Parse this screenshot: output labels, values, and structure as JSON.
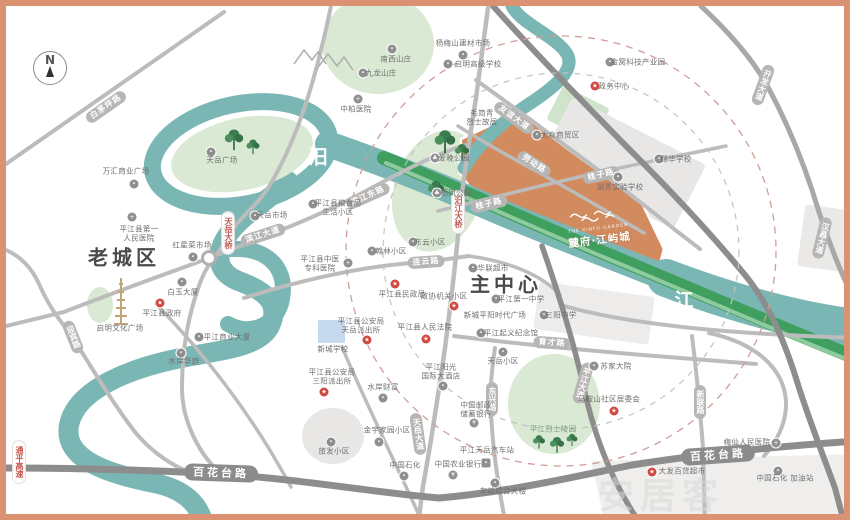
{
  "compass": {
    "letter": "N"
  },
  "project": {
    "name": "麓府·江屿城",
    "latin": "THE XINFU GARDEN"
  },
  "watermark": {
    "text": "安居客"
  },
  "districts": [
    {
      "t": "老城区",
      "x": 118,
      "y": 250
    },
    {
      "t": "主中心",
      "x": 500,
      "y": 277
    }
  ],
  "river_label": {
    "name": "汨罗江",
    "chars": [
      {
        "c": "汨",
        "x": 312,
        "y": 150
      },
      {
        "c": "罗",
        "x": 492,
        "y": 240
      },
      {
        "c": "江",
        "x": 678,
        "y": 293
      }
    ]
  },
  "band_label": {
    "name": "大众风光带",
    "chars": [
      {
        "c": "大",
        "x": 470,
        "y": 221
      },
      {
        "c": "众",
        "x": 498,
        "y": 231
      },
      {
        "c": "风",
        "x": 526,
        "y": 242
      },
      {
        "c": "光",
        "x": 554,
        "y": 252
      },
      {
        "c": "带",
        "x": 582,
        "y": 262
      }
    ]
  },
  "capsules": [
    {
      "t": "白茅坪路",
      "x": 100,
      "y": 101,
      "r": -35
    },
    {
      "t": "滨江大道",
      "x": 257,
      "y": 229,
      "r": -18
    },
    {
      "t": "滨江东路",
      "x": 362,
      "y": 190,
      "r": -24
    },
    {
      "t": "天岳大桥",
      "x": 222,
      "y": 227,
      "v": 1,
      "red": 1
    },
    {
      "t": "连云路",
      "x": 420,
      "y": 256,
      "r": -4
    },
    {
      "t": "汨江大桥",
      "x": 452,
      "y": 206,
      "v": 1,
      "red": 1
    },
    {
      "t": "友谊大道",
      "x": 508,
      "y": 112,
      "r": 36
    },
    {
      "t": "劳动路",
      "x": 528,
      "y": 158,
      "r": 33
    },
    {
      "t": "桂子路",
      "x": 483,
      "y": 198,
      "r": -13
    },
    {
      "t": "桂子路",
      "x": 595,
      "y": 169,
      "r": -13
    },
    {
      "t": "开发大道",
      "x": 757,
      "y": 79,
      "v": 1,
      "r": 20
    },
    {
      "t": "汉昌大道",
      "x": 816,
      "y": 232,
      "v": 1,
      "r": 14
    },
    {
      "t": "育才路",
      "x": 546,
      "y": 337,
      "r": 4
    },
    {
      "t": "东兴路",
      "x": 486,
      "y": 393,
      "v": 1
    },
    {
      "t": "天岳大道",
      "x": 412,
      "y": 428,
      "v": 1,
      "r": -8
    },
    {
      "t": "新联路",
      "x": 694,
      "y": 396,
      "v": 1
    },
    {
      "t": "平江大道",
      "x": 577,
      "y": 377,
      "v": 1,
      "r": 16
    },
    {
      "t": "百花台路",
      "x": 215,
      "y": 467,
      "r": 2,
      "big": 1
    },
    {
      "t": "百花台路",
      "x": 712,
      "y": 449,
      "r": -4,
      "big": 1
    },
    {
      "t": "通平高速",
      "x": 13,
      "y": 456,
      "v": 1,
      "red": 1
    },
    {
      "t": "迎宾路",
      "x": 67,
      "y": 331,
      "v": 1,
      "r": -22
    }
  ],
  "pois": [
    {
      "t": "中柏医院",
      "x": 350,
      "y": 104,
      "ic": "hospital",
      "ix": 352,
      "iy": 93
    },
    {
      "t": "杨梅山建材市场",
      "x": 457,
      "y": 38,
      "ic": "market",
      "ix": 457,
      "iy": 49
    },
    {
      "t": "启明高级学校",
      "x": 472,
      "y": 59,
      "ic": "school",
      "ix": 442,
      "iy": 58
    },
    {
      "t": "南西山庄",
      "x": 390,
      "y": 54,
      "ic": "place",
      "ix": 386,
      "iy": 43
    },
    {
      "t": "九龙山庄",
      "x": 375,
      "y": 68,
      "ic": "place",
      "ix": 357,
      "iy": 67
    },
    {
      "t": "金窝科技产业园",
      "x": 632,
      "y": 57,
      "ic": "place",
      "ix": 604,
      "iy": 56
    },
    {
      "t": "政务中心",
      "x": 608,
      "y": 81,
      "ic": "govt",
      "ix": 589,
      "iy": 80
    },
    {
      "t": "毛简青\n烈士故居",
      "x": 476,
      "y": 112
    },
    {
      "t": "大众商贸区",
      "x": 554,
      "y": 130,
      "ic": "place",
      "ix": 531,
      "iy": 129
    },
    {
      "t": "郧华学校",
      "x": 670,
      "y": 154,
      "ic": "school",
      "ix": 653,
      "iy": 153
    },
    {
      "t": "湖青实验学校",
      "x": 614,
      "y": 182,
      "ic": "school",
      "ix": 612,
      "iy": 171
    },
    {
      "t": "爱晚公园",
      "x": 448,
      "y": 153,
      "ic": "park",
      "ix": 429,
      "iy": 152
    },
    {
      "t": "栖凤公园",
      "x": 450,
      "y": 188,
      "ic": "park",
      "ix": 431,
      "iy": 187
    },
    {
      "t": "天岳广场",
      "x": 216,
      "y": 155,
      "ic": "place",
      "ix": 205,
      "iy": 146
    },
    {
      "t": "万汇商业广场",
      "x": 120,
      "y": 166,
      "ic": "place",
      "ix": 128,
      "iy": 178
    },
    {
      "t": "天岳市场",
      "x": 266,
      "y": 210,
      "ic": "market",
      "ix": 249,
      "iy": 210
    },
    {
      "t": "红星菜市场",
      "x": 186,
      "y": 240,
      "ic": "market",
      "ix": 187,
      "iy": 251
    },
    {
      "t": "平江县第一\n人民医院",
      "x": 133,
      "y": 228,
      "ic": "hospital",
      "ix": 126,
      "iy": 211
    },
    {
      "t": "平江县粮食局\n生活小区",
      "x": 332,
      "y": 202,
      "ic": "place",
      "ix": 307,
      "iy": 198
    },
    {
      "t": "翰林小区",
      "x": 385,
      "y": 246,
      "ic": "place",
      "ix": 366,
      "iy": 245
    },
    {
      "t": "东云小区",
      "x": 424,
      "y": 237,
      "ic": "place",
      "ix": 407,
      "iy": 236
    },
    {
      "t": "平江县中医\n专科医院",
      "x": 314,
      "y": 258,
      "ic": "hospital",
      "ix": 342,
      "iy": 257
    },
    {
      "t": "华联超市",
      "x": 487,
      "y": 263,
      "ic": "market",
      "ix": 467,
      "iy": 262
    },
    {
      "t": "平江第一中学",
      "x": 515,
      "y": 294,
      "ic": "school",
      "ix": 490,
      "iy": 293
    },
    {
      "t": "新城平阳时代广场",
      "x": 489,
      "y": 310
    },
    {
      "t": "三阳中学",
      "x": 555,
      "y": 310,
      "ic": "school",
      "ix": 538,
      "iy": 309
    },
    {
      "t": "平江起义纪念馆",
      "x": 505,
      "y": 328,
      "ic": "place",
      "ix": 475,
      "iy": 327
    },
    {
      "t": "政协机关小区",
      "x": 438,
      "y": 291,
      "ic": "govt",
      "ix": 448,
      "iy": 300
    },
    {
      "t": "平江县民政局",
      "x": 396,
      "y": 289,
      "ic": "govt",
      "ix": 389,
      "iy": 278
    },
    {
      "t": "平江县人民法院",
      "x": 419,
      "y": 322,
      "ic": "govt",
      "ix": 420,
      "iy": 333
    },
    {
      "t": "平江县公安局\n天岳派出所",
      "x": 355,
      "y": 320,
      "ic": "govt",
      "ix": 361,
      "iy": 334
    },
    {
      "t": "新城学校",
      "x": 327,
      "y": 344
    },
    {
      "t": "白玉大厦",
      "x": 177,
      "y": 287,
      "ic": "place",
      "ix": 176,
      "iy": 276
    },
    {
      "t": "平江县政府",
      "x": 156,
      "y": 308,
      "ic": "govt",
      "ix": 154,
      "iy": 297
    },
    {
      "t": "启明文化广场",
      "x": 114,
      "y": 323
    },
    {
      "t": "水岸华庭",
      "x": 178,
      "y": 356,
      "ic": "place",
      "ix": 175,
      "iy": 347
    },
    {
      "t": "平江商业大厦",
      "x": 221,
      "y": 332,
      "ic": "place",
      "ix": 193,
      "iy": 331
    },
    {
      "t": "水岸财富",
      "x": 377,
      "y": 382,
      "ic": "place",
      "ix": 377,
      "iy": 392
    },
    {
      "t": "平江县公安局\n三阳派出所",
      "x": 326,
      "y": 371,
      "ic": "govt",
      "ix": 318,
      "iy": 386
    },
    {
      "t": "旅发小区",
      "x": 328,
      "y": 446,
      "ic": "place",
      "ix": 325,
      "iy": 436
    },
    {
      "t": "金宇家园小区",
      "x": 381,
      "y": 425,
      "ic": "place",
      "ix": 373,
      "iy": 436
    },
    {
      "t": "中国石化",
      "x": 399,
      "y": 460,
      "ic": "gas",
      "ix": 398,
      "iy": 470
    },
    {
      "t": "中国农业银行",
      "x": 452,
      "y": 459,
      "ic": "bank",
      "ix": 447,
      "iy": 469
    },
    {
      "t": "中国邮政\n储蓄银行",
      "x": 470,
      "y": 404,
      "ic": "bank",
      "ix": 468,
      "iy": 417
    },
    {
      "t": "平江阳光\n国际大酒店",
      "x": 435,
      "y": 366,
      "ic": "place",
      "ix": 437,
      "iy": 380
    },
    {
      "t": "平江天岳汽车站",
      "x": 481,
      "y": 445,
      "ic": "bus",
      "ix": 480,
      "iy": 457
    },
    {
      "t": "车站综合大楼",
      "x": 497,
      "y": 486,
      "ic": "place",
      "ix": 489,
      "iy": 477
    },
    {
      "t": "天岳小区",
      "x": 497,
      "y": 356,
      "ic": "place",
      "ix": 497,
      "iy": 346
    },
    {
      "t": "平江烈士陵园",
      "x": 547,
      "y": 424,
      "cls": "green"
    },
    {
      "t": "苏家大院",
      "x": 610,
      "y": 361,
      "ic": "place",
      "ix": 588,
      "iy": 360
    },
    {
      "t": "马鞍山社区居委会",
      "x": 603,
      "y": 394,
      "ic": "govt",
      "ix": 608,
      "iy": 405
    },
    {
      "t": "梅仙人民医院",
      "x": 741,
      "y": 437,
      "ic": "hospital",
      "ix": 770,
      "iy": 437
    },
    {
      "t": "大发百货超市",
      "x": 676,
      "y": 466,
      "ic": "govt",
      "ix": 646,
      "iy": 466
    },
    {
      "t": "中国石化 加油站",
      "x": 779,
      "y": 473,
      "ic": "gas",
      "ix": 772,
      "iy": 465
    }
  ],
  "colors": {
    "frame": "#db9273",
    "river": "#7ab7b4",
    "scenic_band": "#46a465",
    "park": "#d9e9d4",
    "project_parcel": "#d28a5f",
    "government_red": "#d04a42",
    "road_dark": "#8d8d8d",
    "road_light": "#bcbcbc"
  }
}
